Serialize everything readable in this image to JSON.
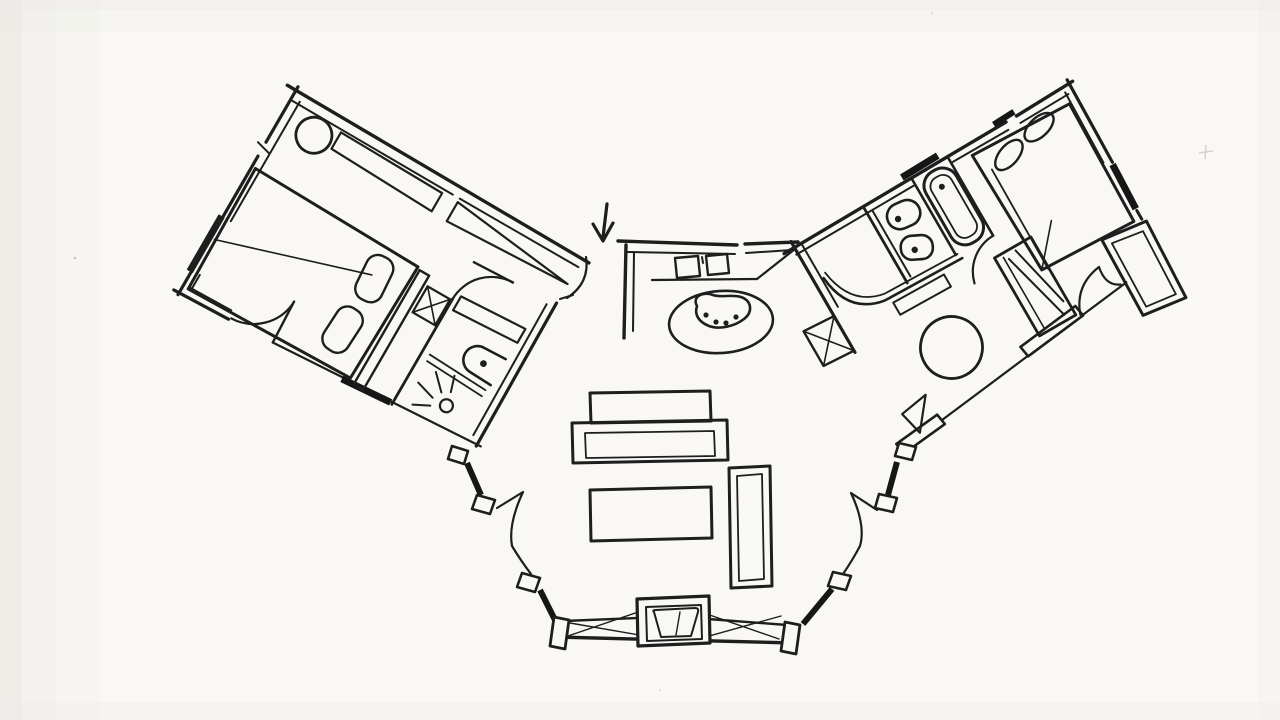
{
  "document": {
    "title": "Hand-drawn butterfly floor plan sketch",
    "medium": "black ink freehand sketch on scanned white paper",
    "visible_text": "none"
  },
  "palette": {
    "ink": "#1e1e1e",
    "paper": "#f9f8f5",
    "edge_shade": "#e7e4df"
  },
  "entry": {
    "label": "Main entry",
    "arrow_symbol": "↓",
    "elements": [
      "entry-arrow",
      "swing-door-arc"
    ]
  },
  "left_wing": {
    "label": "Left bedroom wing",
    "rotation_deg": 30,
    "bedroom": {
      "label": "Left bedroom",
      "furniture": [
        "round-stool",
        "wall-shelf",
        "tapered-closet",
        "double-bed",
        "turned-down-cover-line",
        "pillow",
        "pillow",
        "headboard-rail",
        "x-leg-bench"
      ]
    },
    "bathroom": {
      "label": "Left ensuite bathroom",
      "fixtures": [
        "swing-door-arc",
        "vanity-counter",
        "wash-basin-with-dot",
        "low-shelf",
        "shower-drain",
        "water-spray-lines"
      ]
    },
    "openings": [
      "terrace-door-arc",
      "window-bar-left-wall",
      "window-bar-lower-wall",
      "glazed-lower-wall"
    ]
  },
  "kitchen": {
    "label": "Kitchen nook",
    "features": [
      "L-counter-wall",
      "sink-square",
      "cooktop-square",
      "counter-edge",
      "diagonal-partition",
      "x-braced-shaft",
      "oval-rug",
      "kidney-island",
      "four-seat-dots"
    ]
  },
  "right_wing": {
    "label": "Right bedroom wing",
    "rotation_deg": -30,
    "bathroom": {
      "label": "Right bathroom",
      "fixtures": [
        "wash-basin-with-dot",
        "toilet-with-dot",
        "vanity-line",
        "bathtub-with-drain-dot",
        "tub-nook-walls",
        "swing-door-arc",
        "corridor-bench"
      ]
    },
    "bedroom": {
      "label": "Right bedroom",
      "furniture": [
        "double-bed",
        "oval-pillow",
        "oval-pillow",
        "sheet-line",
        "fold-line",
        "hatched-wardrobe",
        "round-table"
      ]
    },
    "closet": {
      "label": "Walk-in closet",
      "openings": [
        "scallop-door-swing"
      ]
    },
    "openings": [
      "window-bar-top-wall",
      "window-bar-top-wall-2",
      "window-bar-end-wall",
      "glazed-lower-wall",
      "white-window-slabs",
      "triangle-door-leaf"
    ]
  },
  "living_room": {
    "label": "Living room",
    "furniture": [
      "sofa-back",
      "sofa-seat",
      "coffee-table",
      "side-bench",
      "fireplace",
      "firebox"
    ],
    "openings": [
      "left-corner-posts",
      "right-corner-posts",
      "left-swing-door",
      "right-swing-door",
      "glazed-wall-mullions",
      "dark-glazing-bars"
    ]
  },
  "scan_artifacts": {
    "specks": 4,
    "edge_shading": "left and top edges slightly grey"
  }
}
